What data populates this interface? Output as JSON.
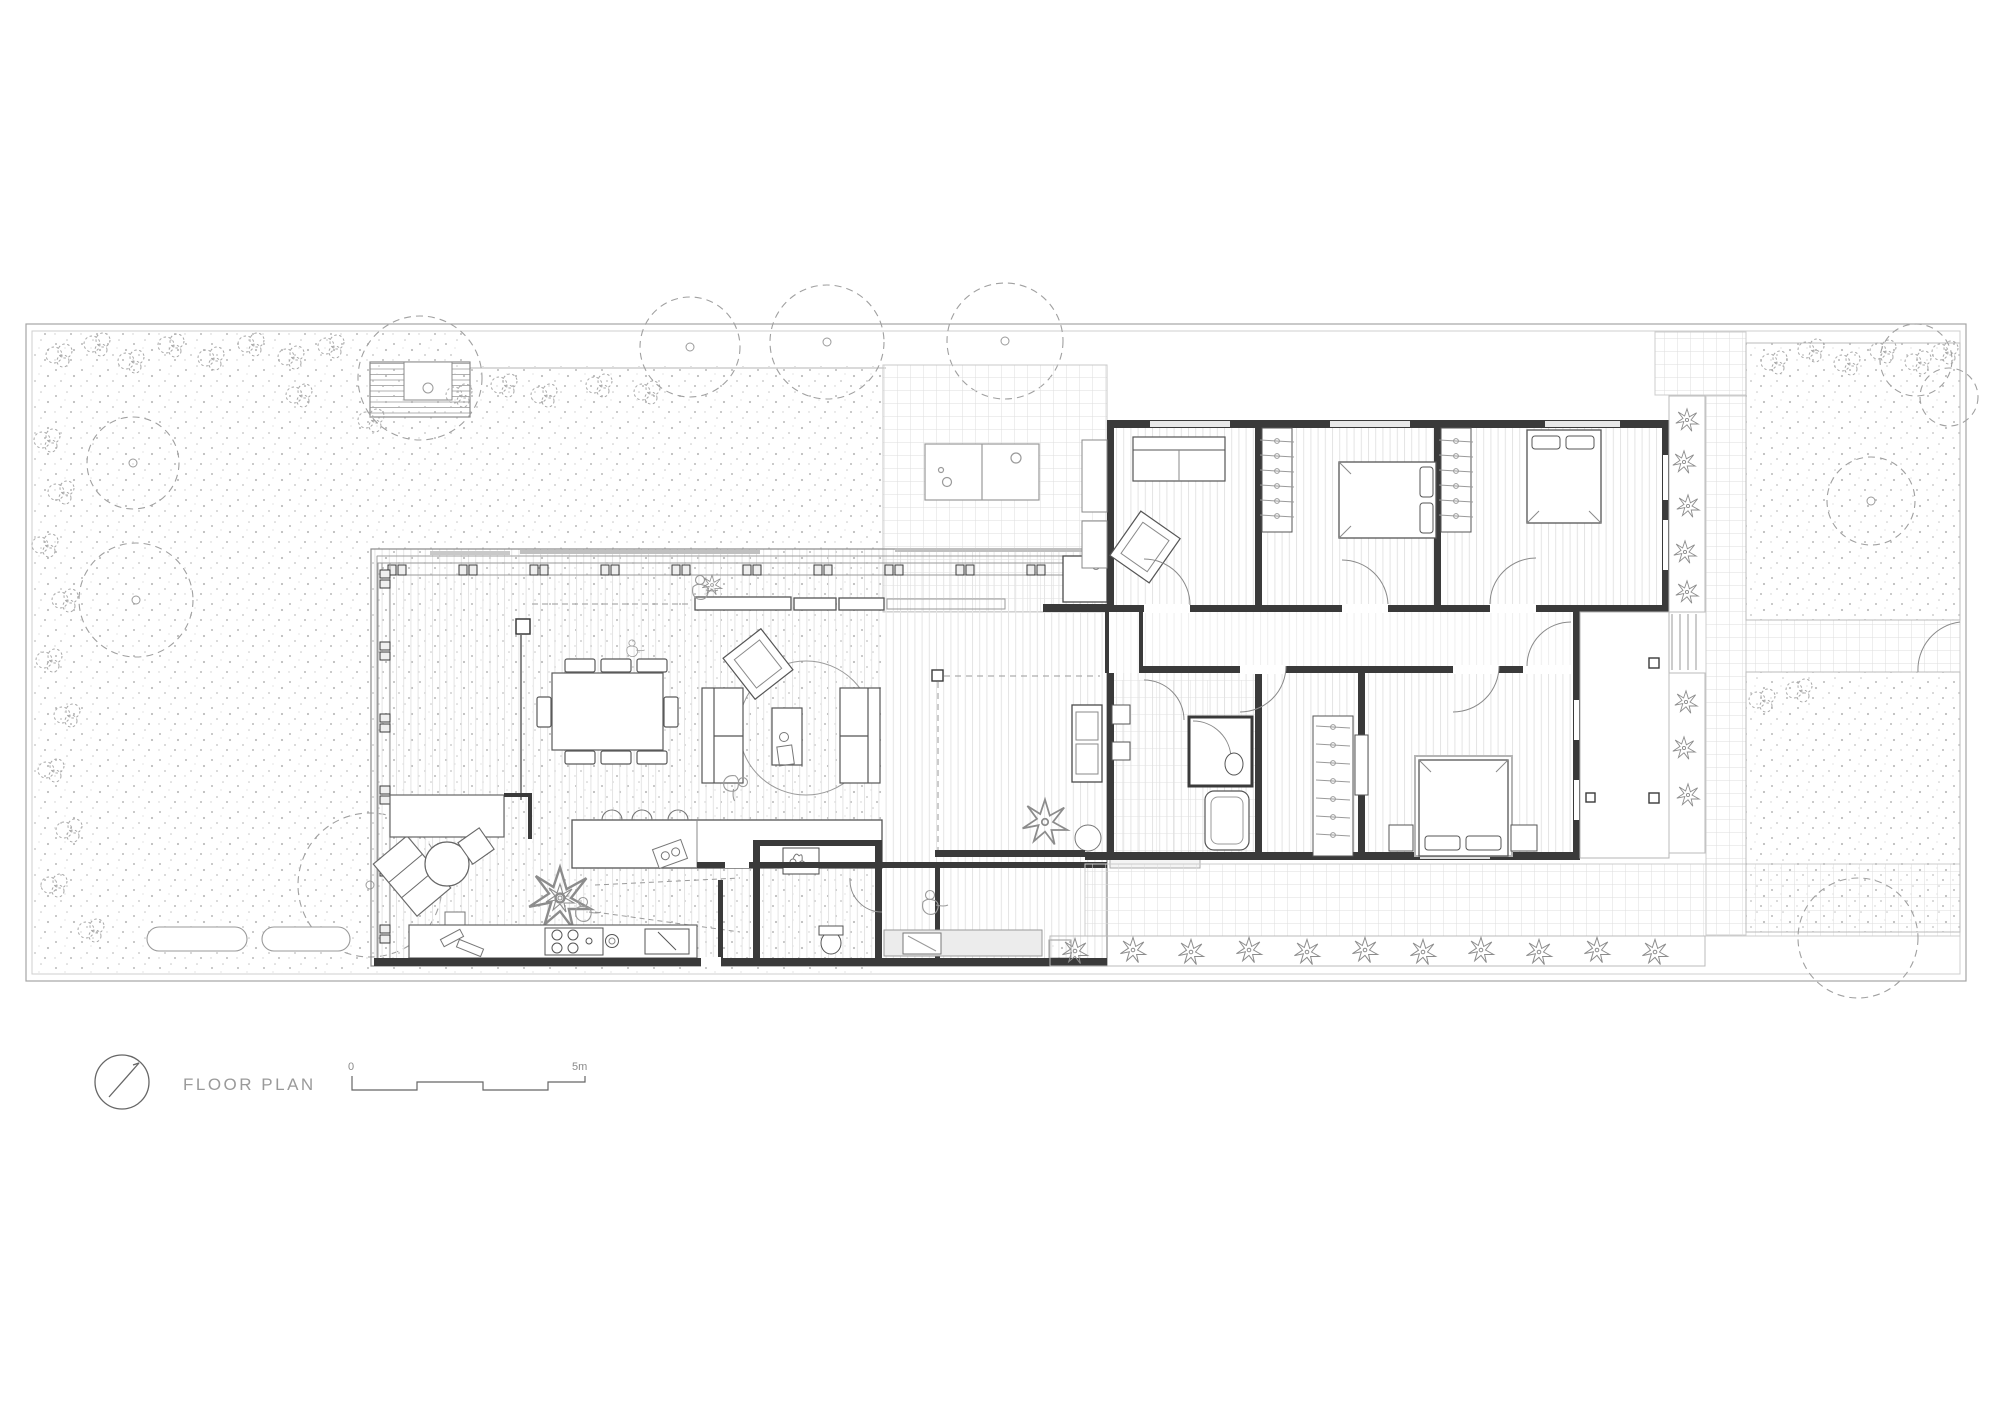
{
  "drawing": {
    "type": "architectural floor plan",
    "title": "FLOOR PLAN",
    "scale_bar": {
      "start": "0",
      "end": "5m"
    }
  },
  "colors": {
    "paper": "#ffffff",
    "wall_ink": "#3a3a3a",
    "line_ink": "#555555",
    "mid_gray": "#8a8a8a",
    "faint_gray": "#dcdcdc"
  },
  "icons": {
    "north_arrow": "north-arrow-icon",
    "trees": "tree-canopy-dashed-circle",
    "shrubs": "shrub-scribble",
    "plants": "plant-star"
  }
}
